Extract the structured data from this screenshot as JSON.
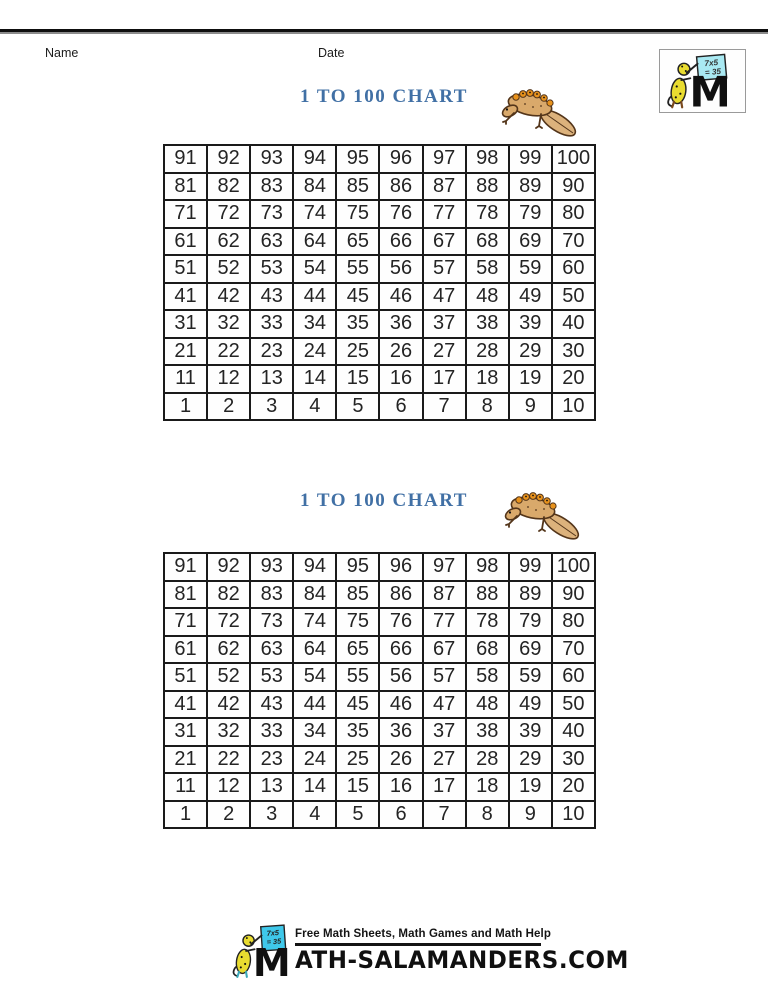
{
  "header": {
    "name_label": "Name",
    "date_label": "Date"
  },
  "chart": {
    "title": "1 TO 100 CHART",
    "rows": [
      [
        91,
        92,
        93,
        94,
        95,
        96,
        97,
        98,
        99,
        100
      ],
      [
        81,
        82,
        83,
        84,
        85,
        86,
        87,
        88,
        89,
        90
      ],
      [
        71,
        72,
        73,
        74,
        75,
        76,
        77,
        78,
        79,
        80
      ],
      [
        61,
        62,
        63,
        64,
        65,
        66,
        67,
        68,
        69,
        70
      ],
      [
        51,
        52,
        53,
        54,
        55,
        56,
        57,
        58,
        59,
        60
      ],
      [
        41,
        42,
        43,
        44,
        45,
        46,
        47,
        48,
        49,
        50
      ],
      [
        31,
        32,
        33,
        34,
        35,
        36,
        37,
        38,
        39,
        40
      ],
      [
        21,
        22,
        23,
        24,
        25,
        26,
        27,
        28,
        29,
        30
      ],
      [
        11,
        12,
        13,
        14,
        15,
        16,
        17,
        18,
        19,
        20
      ],
      [
        1,
        2,
        3,
        4,
        5,
        6,
        7,
        8,
        9,
        10
      ]
    ]
  },
  "logo": {
    "board_line1": "7x5",
    "board_line2": "= 35",
    "letter": "M"
  },
  "footer": {
    "tagline": "Free Math Sheets, Math Games and Math Help",
    "site_rest": "ATH-SALAMANDERS.COM"
  },
  "colors": {
    "title_blue": "#4170a5",
    "grid_border": "#1a1a1a",
    "board_cyan": "#7fdef0",
    "salamander_yellow": "#e9dc30",
    "newt_body_tan": "#d9a96b",
    "newt_crest_orange": "#e8921c",
    "rule_black": "#0e0e0e",
    "rule_gray": "#8c8c8c"
  }
}
